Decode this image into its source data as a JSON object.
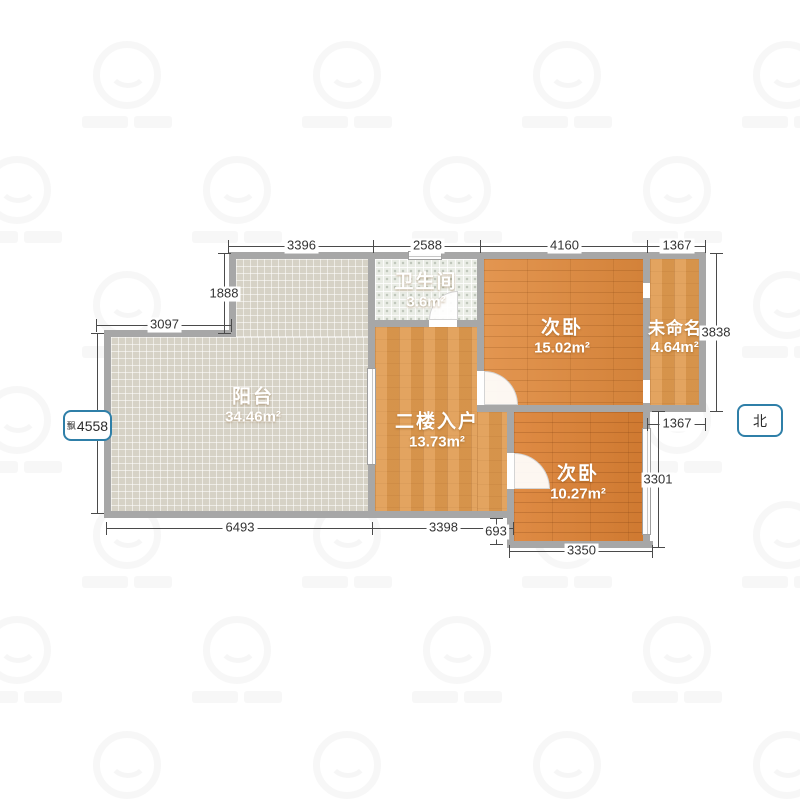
{
  "plan": {
    "compass_label": "北",
    "rooms": [
      {
        "id": "balcony",
        "name": "阳台",
        "area": "34.46m²"
      },
      {
        "id": "bathroom",
        "name": "卫生间",
        "area": "3.6m²"
      },
      {
        "id": "bedroom-upper",
        "name": "次卧",
        "area": "15.02m²"
      },
      {
        "id": "unnamed",
        "name": "未命名",
        "area": "4.64m²"
      },
      {
        "id": "entry",
        "name": "二楼入户",
        "area": "13.73m²"
      },
      {
        "id": "bedroom-lower",
        "name": "次卧",
        "area": "10.27m²"
      }
    ],
    "dimensions": {
      "top": [
        "3396",
        "2588",
        "4160",
        "1367"
      ],
      "left_upper_vertical": "1888",
      "left_notch_horizontal": "3097",
      "left_selected": {
        "prefix": "飘",
        "value": "4558"
      },
      "bottom": [
        "6493",
        "3398"
      ],
      "bottom_step_vertical": "693",
      "bottom_bedroom": "3350",
      "right_unnamed_vertical": "3838",
      "right_unnamed_bottom": "1367",
      "right_bedroom_vertical": "3301"
    },
    "colors": {
      "accent_blue": "#2f7fa8",
      "wall_gray": "#a7a7a7",
      "bedroom_wood": "#e08a3d",
      "entry_wood": "#e09a4e",
      "balcony_tile": "#d6d2c6",
      "bathroom_tile": "#e9ece5",
      "dimension_text": "#333333"
    }
  }
}
